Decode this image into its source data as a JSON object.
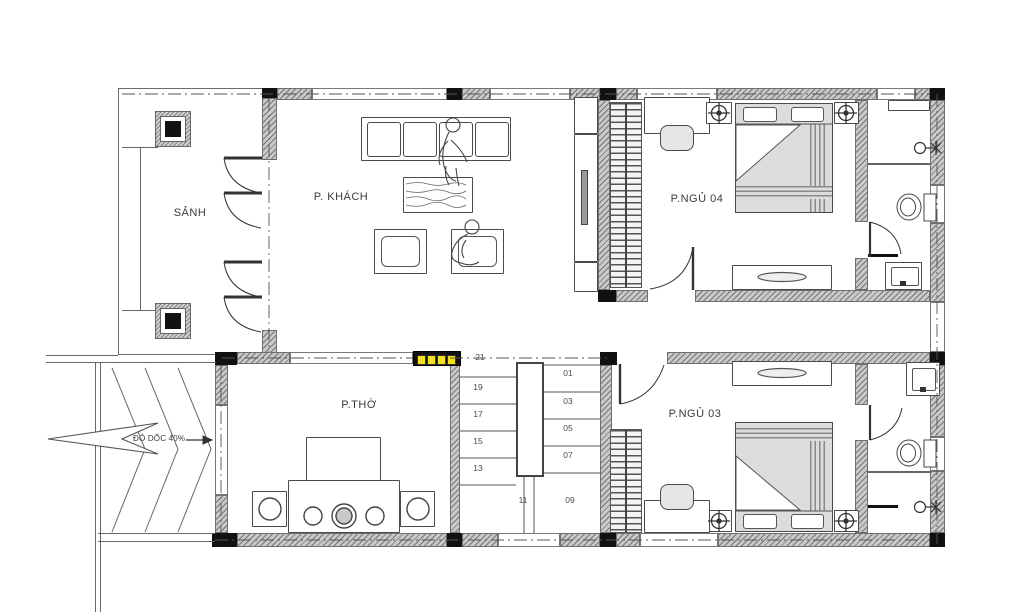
{
  "title": "Floor plan",
  "rooms": {
    "hall": {
      "label": "SẢNH"
    },
    "living": {
      "label": "P. KHÁCH"
    },
    "worship": {
      "label": "P.THỜ"
    },
    "bedroom4": {
      "label": "P.NGỦ 04"
    },
    "bedroom3": {
      "label": "P.NGỦ 03"
    }
  },
  "ramp": {
    "label": "ĐỘ DỐC 40%"
  },
  "stairs": {
    "left_steps": [
      "21",
      "19",
      "17",
      "15",
      "13",
      "11"
    ],
    "right_steps": [
      "01",
      "03",
      "05",
      "07",
      "09"
    ]
  },
  "icons": [
    "door-swing-icon",
    "toilet-icon",
    "sink-icon",
    "shower-faucet-icon",
    "ceiling-lamp-icon",
    "bed-icon",
    "sofa-icon",
    "altar-icon",
    "stair-icon",
    "ramp-chevron-icon",
    "entry-arrow-icon"
  ],
  "colors": {
    "wall": "#c9c9c9",
    "column": "#111111",
    "highlight": "#f2e11c",
    "bed_fill": "#dcdcdc",
    "line": "#4a4a4a"
  }
}
